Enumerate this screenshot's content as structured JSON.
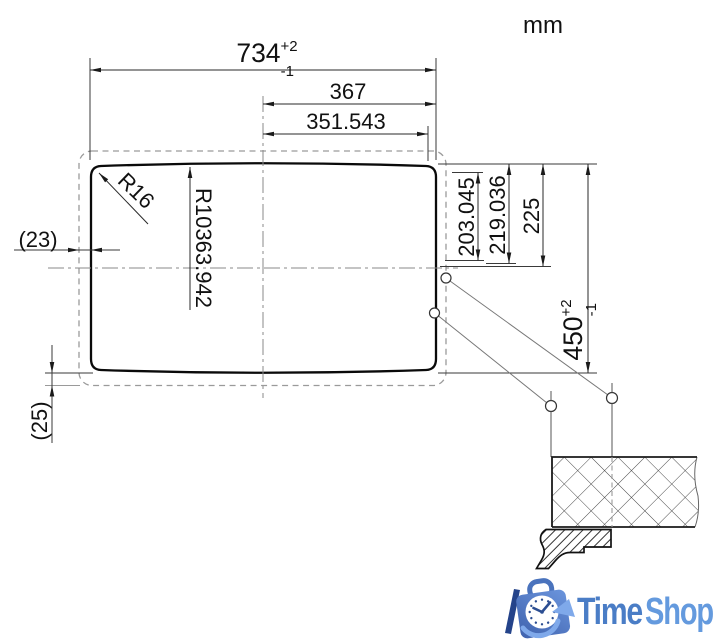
{
  "unit": {
    "label": "mm"
  },
  "dimensions": {
    "overall_width": {
      "value": "734",
      "tol_plus": "+2",
      "tol_minus": "-1"
    },
    "hole_span": "367",
    "hole_span_ref": "351.543",
    "corner_radius": "R16",
    "edge_radius": "R10363.942",
    "ref_left": "(23)",
    "ref_bottom": "(25)",
    "vert_hole1": "203.045",
    "vert_hole2": "219.036",
    "vert_center": "225",
    "overall_height": {
      "value": "450",
      "tol_plus": "+2",
      "tol_minus": "-1"
    }
  },
  "logo": {
    "name_part1": "Time",
    "name_part2": "Shop"
  },
  "colors": {
    "outline": "#0a0a0a",
    "dimension_line": "#2a2a2a",
    "dashed_line": "#9a9a9a",
    "centerline": "#8a8a8a",
    "logo_dark_blue": "#24438a",
    "logo_blue": "#4a73bd",
    "logo_light_blue": "#7fa9ea",
    "logo_text_time": "#4a7dc6",
    "logo_text_shop": "#649ade"
  }
}
